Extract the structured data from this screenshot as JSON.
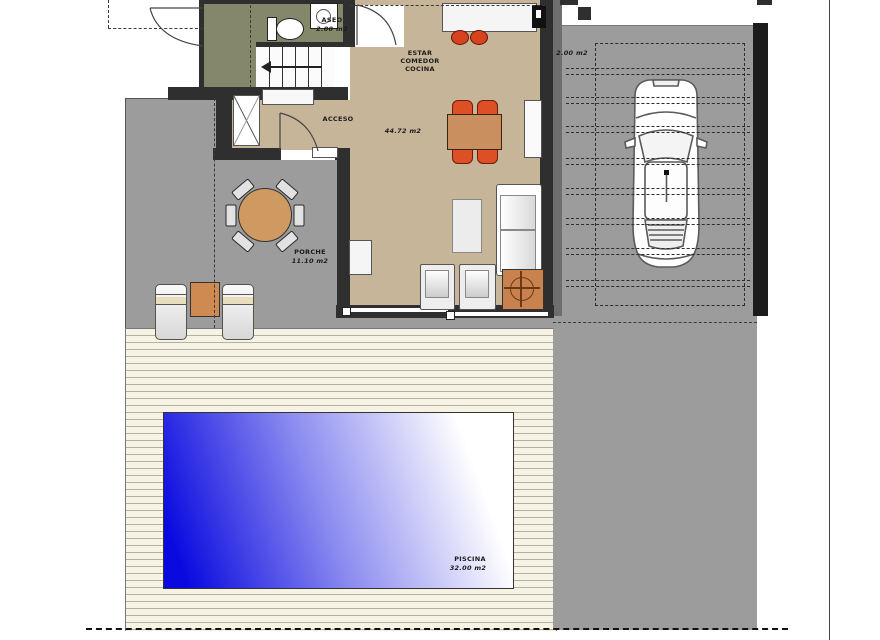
{
  "plan": {
    "title": "villa-ground-floor-plan",
    "rooms": {
      "aseo": {
        "name": "ASEO",
        "area": "2.00 m2"
      },
      "estar": {
        "line1": "ESTAR",
        "line2": "COMEDOR",
        "line3": "COCINA",
        "area": "44.72 m2"
      },
      "acceso": {
        "name": "ACCESO"
      },
      "porche": {
        "name": "PORCHE",
        "area": "11.10 m2"
      },
      "piscina": {
        "name": "PISCINA",
        "area": "32.00 m2"
      },
      "carport": {
        "area": "2.00 m2"
      }
    },
    "colors": {
      "wall": "#2f2f2f",
      "floor_tan": "#c7b59a",
      "aseo_olive": "#85876b",
      "paving_gray": "#9c9c9c",
      "deck_cream": "#f6f3e4",
      "deck_line": "#b5b1a0",
      "pool_blue": "#0a0ae0",
      "table_orange": "#c98f5e",
      "chair_red": "#dd4f24"
    }
  }
}
